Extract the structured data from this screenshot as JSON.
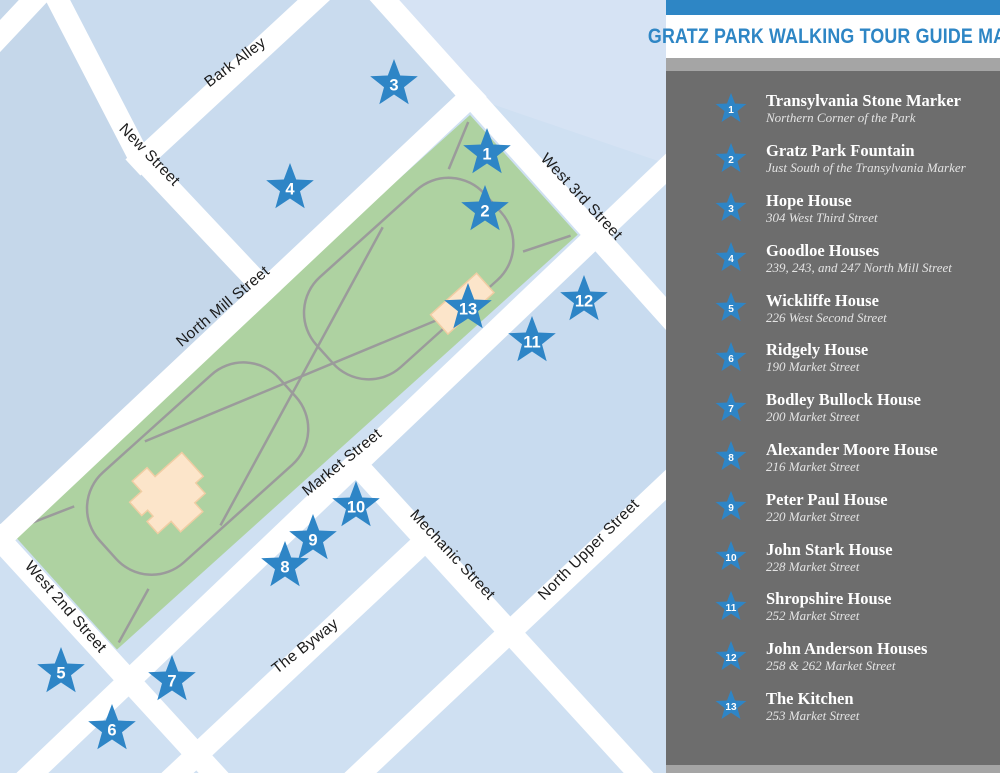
{
  "header": {
    "title": "GRATZ PARK WALKING TOUR GUIDE MAP"
  },
  "legend": {
    "items": [
      {
        "number": "1",
        "title": "Transylvania Stone Marker",
        "subtitle": "Northern Corner of the Park"
      },
      {
        "number": "2",
        "title": "Gratz Park Fountain",
        "subtitle": "Just South of the Transylvania Marker"
      },
      {
        "number": "3",
        "title": "Hope House",
        "subtitle": "304 West Third Street"
      },
      {
        "number": "4",
        "title": "Goodloe Houses",
        "subtitle": "239, 243, and 247 North Mill Street"
      },
      {
        "number": "5",
        "title": "Wickliffe House",
        "subtitle": "226 West Second Street"
      },
      {
        "number": "6",
        "title": "Ridgely House",
        "subtitle": "190 Market Street"
      },
      {
        "number": "7",
        "title": "Bodley Bullock House",
        "subtitle": "200 Market Street"
      },
      {
        "number": "8",
        "title": "Alexander Moore House",
        "subtitle": "216 Market Street"
      },
      {
        "number": "9",
        "title": "Peter Paul House",
        "subtitle": "220 Market Street"
      },
      {
        "number": "10",
        "title": "John Stark House",
        "subtitle": "228 Market Street"
      },
      {
        "number": "11",
        "title": "Shropshire House",
        "subtitle": "252 Market Street"
      },
      {
        "number": "12",
        "title": "John Anderson Houses",
        "subtitle": "258 & 262 Market Street"
      },
      {
        "number": "13",
        "title": "The Kitchen",
        "subtitle": "253 Market Street"
      }
    ]
  },
  "map": {
    "street_labels": [
      {
        "text": "Bark Alley"
      },
      {
        "text": "New Street"
      },
      {
        "text": "West 3rd Street"
      },
      {
        "text": "North Mill Street"
      },
      {
        "text": "Market Street"
      },
      {
        "text": "West 2nd Street"
      },
      {
        "text": "Mechanic Street"
      },
      {
        "text": "The Byway"
      },
      {
        "text": "North Upper Street"
      }
    ],
    "markers": [
      {
        "number": "1"
      },
      {
        "number": "2"
      },
      {
        "number": "3"
      },
      {
        "number": "4"
      },
      {
        "number": "5"
      },
      {
        "number": "6"
      },
      {
        "number": "7"
      },
      {
        "number": "8"
      },
      {
        "number": "9"
      },
      {
        "number": "10"
      },
      {
        "number": "11"
      },
      {
        "number": "12"
      },
      {
        "number": "13"
      }
    ]
  },
  "colors": {
    "accent_blue": "#2e86c5",
    "star_blue": "#2e85c6",
    "panel_gray": "#6d6d6d",
    "strip_gray": "#a5a5a5",
    "map_background": "#cfe0f2",
    "park_green": "#aed2a1",
    "street_white": "#ffffff",
    "building_beige": "#fce5ca",
    "path_gray": "#9b9b9b"
  }
}
